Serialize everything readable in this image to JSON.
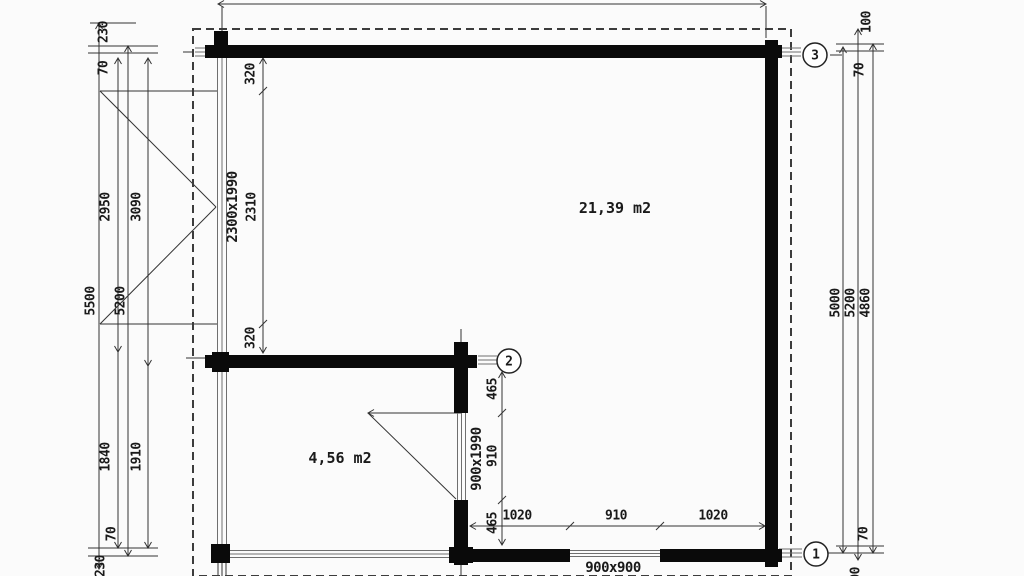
{
  "style": {
    "ink": "#1a1a1a",
    "wall_fill": "#0a0a0a",
    "thin_line": "#6f6f6f",
    "dash_line": "#3c3c3c",
    "paper": "#fbfbfb"
  },
  "plan": {
    "rooms": {
      "main_area": "21,39 m2",
      "veranda_area": "4,56 m2"
    },
    "openings": {
      "front_door": "2300x1990",
      "inner_door": "900x1990",
      "window": "900x900"
    },
    "axes": {
      "a1": "1",
      "a2": "2",
      "a3": "3"
    },
    "dims": {
      "top_overall": "5000",
      "left": {
        "l230_top": "230",
        "l70_top": "70",
        "l2950": "2950",
        "l3090": "3090",
        "l5500": "5500",
        "l5200": "5200",
        "l1840": "1840",
        "l1910": "1910",
        "l70_bottom": "70",
        "l230_bottom": "230"
      },
      "front_chain": {
        "s1": "320",
        "s2": "2310",
        "s3": "320"
      },
      "inner_chain": {
        "s1": "465",
        "s2": "910",
        "s3": "465"
      },
      "bottom_chain": {
        "s1": "1020",
        "s2": "910",
        "s3": "1020"
      },
      "right": {
        "r100_top": "100",
        "r70_top": "70",
        "r5000": "5000",
        "r5200": "5200",
        "r4860": "4860",
        "r70_bottom": "70",
        "r100_bottom": "100"
      }
    }
  }
}
